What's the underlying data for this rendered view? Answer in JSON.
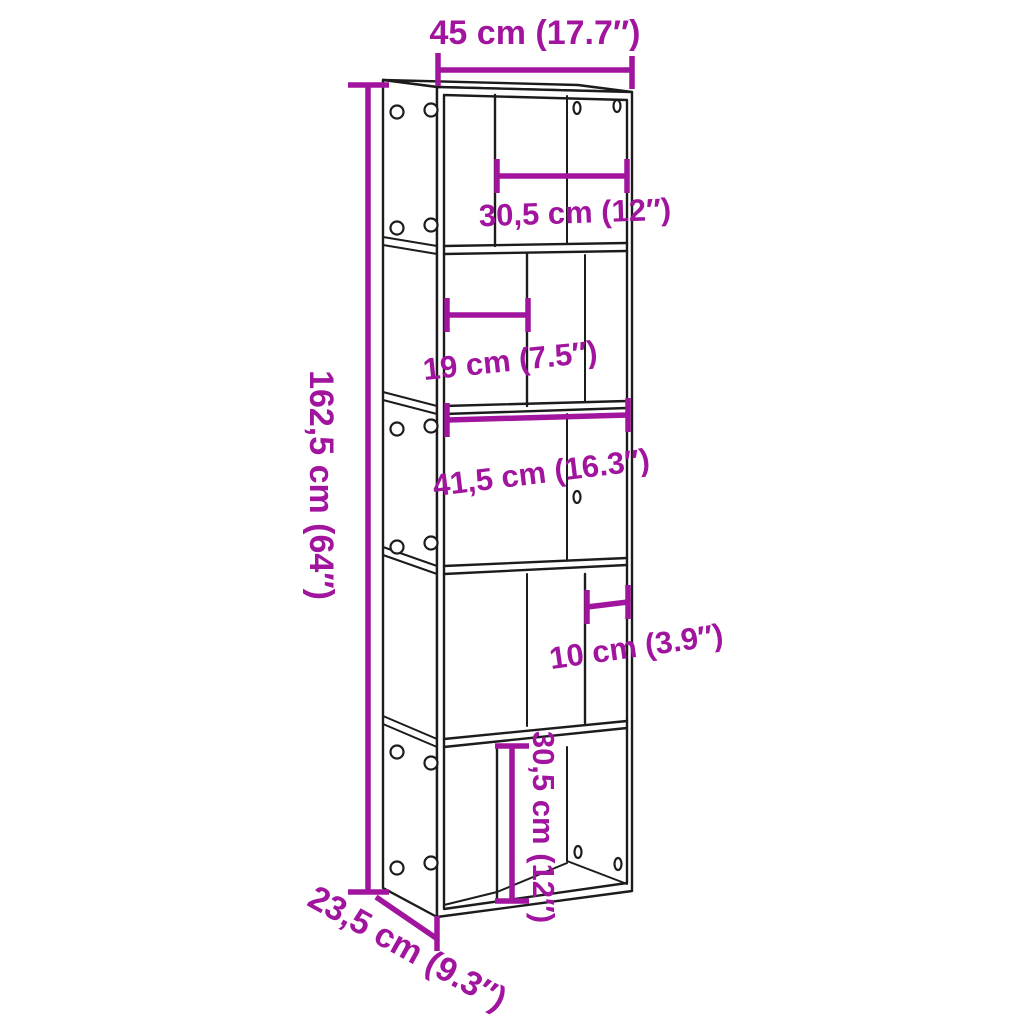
{
  "figure": {
    "kind": "product-dimension-diagram",
    "subject": "5-tier-bookcase-line-drawing",
    "background_color": "#FFFFFF",
    "line_color": "#1C1C1C",
    "accent_color": "#A1149E"
  },
  "dims": {
    "width_total": {
      "label": "45 cm (17.7″)",
      "value_cm": 45,
      "value_in": 17.7
    },
    "tier1_compartment": {
      "label": "30,5 cm (12″)",
      "value_cm": 30.5,
      "value_in": 12
    },
    "tier2_compartment": {
      "label": "19 cm (7.5″)",
      "value_cm": 19,
      "value_in": 7.5
    },
    "tier3_interior": {
      "label": "41,5 cm (16.3″)",
      "value_cm": 41.5,
      "value_in": 16.3
    },
    "tier4_compartment": {
      "label": "10 cm (3.9″)",
      "value_cm": 10,
      "value_in": 3.9
    },
    "tier5_height": {
      "label": "30,5 cm (12″)",
      "value_cm": 30.5,
      "value_in": 12
    },
    "height_total": {
      "label": "162,5 cm (64″)",
      "value_cm": 162.5,
      "value_in": 64
    },
    "depth_total": {
      "label": "23,5 cm (9.3″)",
      "value_cm": 23.5,
      "value_in": 9.3
    }
  }
}
